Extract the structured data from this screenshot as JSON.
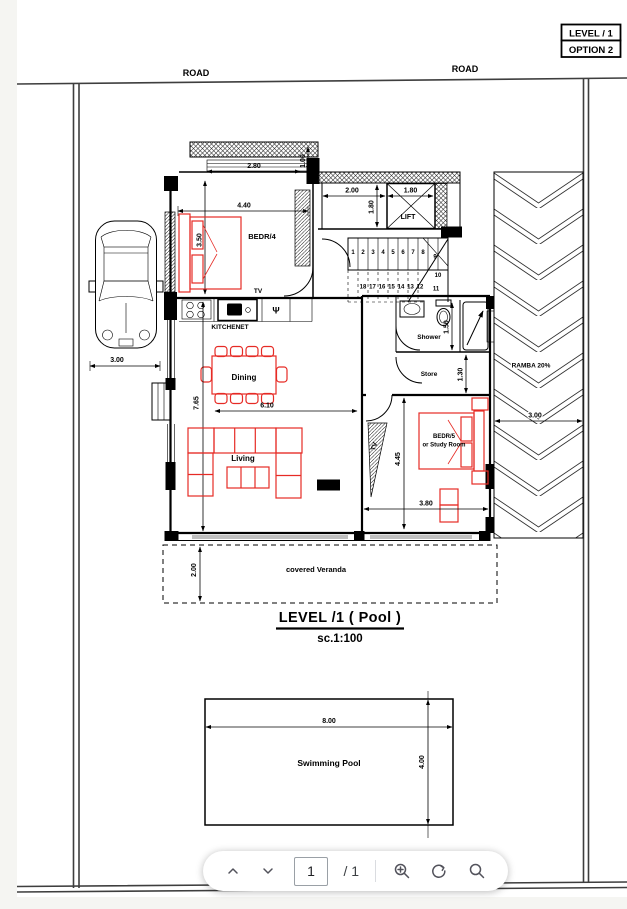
{
  "header": {
    "road_left": "ROAD",
    "road_right": "ROAD",
    "level_label": "LEVEL / 1",
    "option_label": "OPTION 2"
  },
  "plan": {
    "rooms": {
      "bedr4": "BEDR/4",
      "tv_wall": "TV",
      "kitchenet": "KITCHENET",
      "psi": "Ψ",
      "lift": "LIFT",
      "shower": "Shower",
      "store": "Store",
      "bedr5_line1": "BEDR/5",
      "bedr5_line2": "or Study Room",
      "tv_side": "TV",
      "dining": "Dining",
      "living": "Living",
      "veranda": "covered Veranda",
      "ramp": "RAMBA 20%",
      "pool": "Swimming Pool"
    },
    "dims": {
      "d280": "2.80",
      "d100": "1.00",
      "d440": "4.40",
      "d350": "3.50",
      "d200L": "2.00",
      "d180a": "1.80",
      "d180b": "1.80",
      "car300": "3.00",
      "d765": "7.65",
      "d610": "6.10",
      "d150": "1.50",
      "d130": "1.30",
      "d445": "4.45",
      "d380": "3.80",
      "ramp300": "3.00",
      "ver200": "2.00",
      "pool800": "8.00",
      "pool400": "4.00"
    },
    "stairs": {
      "up": [
        "1",
        "2",
        "3",
        "4",
        "5",
        "6",
        "7",
        "8"
      ],
      "turn": [
        "9",
        "10",
        "11"
      ],
      "down": [
        "18",
        "17",
        "16",
        "15",
        "14",
        "13",
        "12"
      ]
    },
    "title": "LEVEL /1 ( Pool )",
    "scale": "sc.1:100"
  },
  "toolbar": {
    "page_value": "1",
    "page_total": "/ 1",
    "icons": [
      "chevron-up",
      "chevron-down",
      "zoom-in",
      "rotate-ccw",
      "search"
    ]
  },
  "colors": {
    "furniture_red": "#e62b25",
    "wall_black": "#000000",
    "site_line": "#3e3e3e",
    "toolbar_icon": "#52525b"
  }
}
